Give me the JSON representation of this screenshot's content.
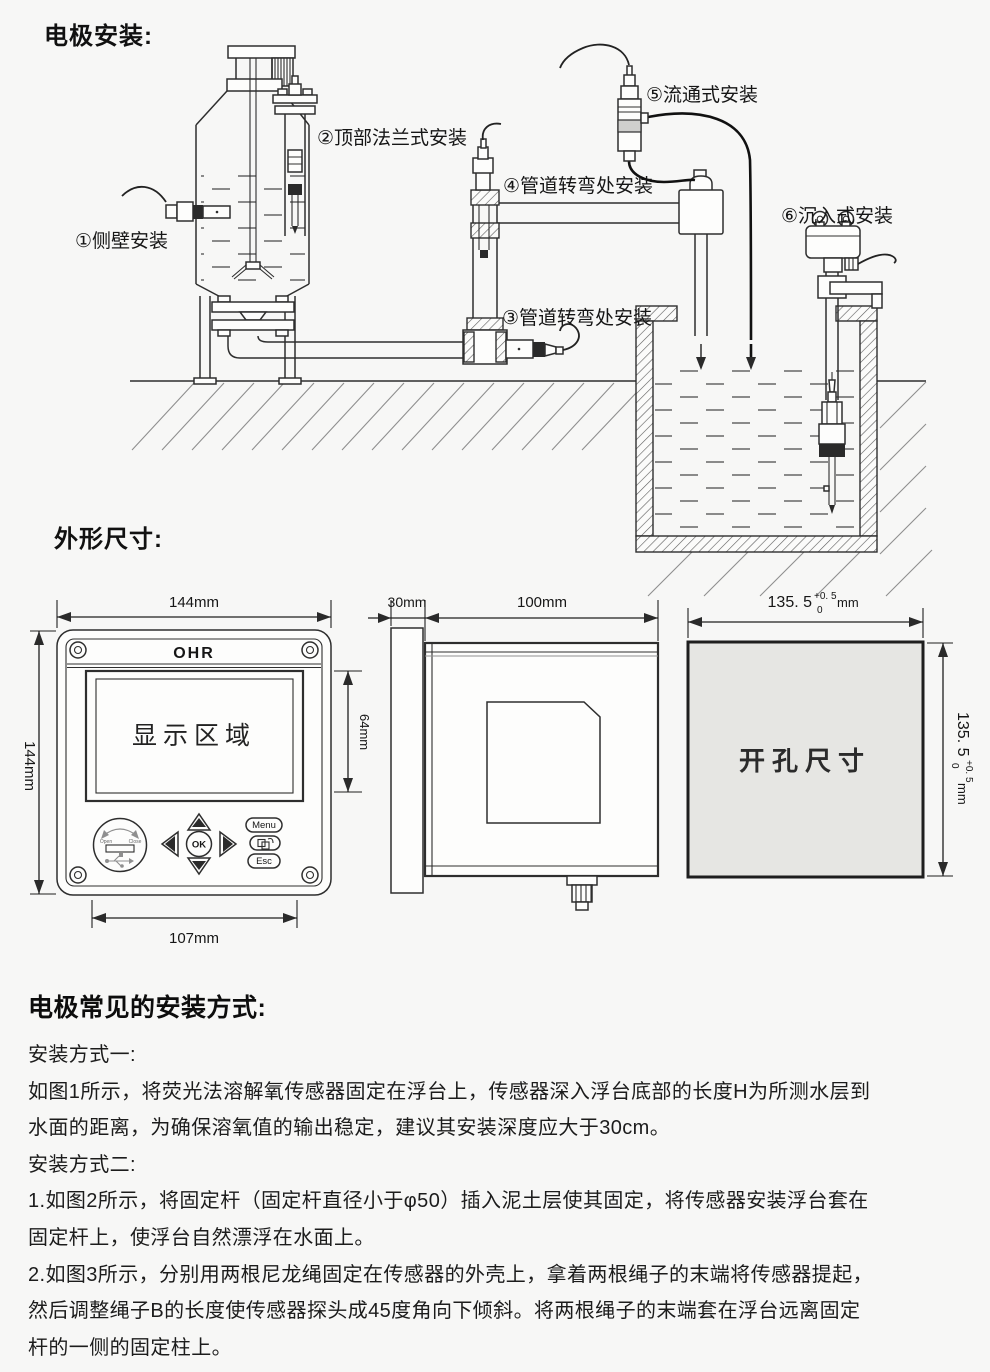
{
  "titles": {
    "electrode_install": "电极安装:",
    "outline_dims": "外形尺寸:",
    "common_methods": "电极常见的安装方式:"
  },
  "diagram_labels": {
    "l1": "①侧壁安装",
    "l2": "②顶部法兰式安装",
    "l3": "③管道转弯处安装",
    "l4": "④管道转弯处安装",
    "l5": "⑤流通式安装",
    "l6": "⑥沉入式安装"
  },
  "front_view": {
    "brand": "OHR",
    "display_area": "显示区域",
    "dim_width": "144mm",
    "dim_height": "144mm",
    "dim_display": "64mm",
    "dim_keypad": "107mm",
    "btn_menu": "Menu",
    "btn_esc": "Esc",
    "btn_ok": "OK",
    "usb_open": "Open",
    "usb_close": "Close"
  },
  "side_view": {
    "dim_bezel": "30mm",
    "dim_depth": "100mm"
  },
  "cutout_view": {
    "label": "开孔尺寸",
    "dim_value": "135. 5",
    "tol_plus": "+0. 5",
    "tol_minus": "0",
    "unit": "mm"
  },
  "methods_text": {
    "lines": [
      "安装方式一:",
      "如图1所示，将荧光法溶解氧传感器固定在浮台上，传感器深入浮台底部的长度H为所测水层到",
      "水面的距离，为确保溶氧值的输出稳定，建议其安装深度应大于30cm。",
      "安装方式二:",
      "1.如图2所示，将固定杆（固定杆直径小于φ50）插入泥土层使其固定，将传感器安装浮台套在",
      "固定杆上，使浮台自然漂浮在水面上。",
      "2.如图3所示，分别用两根尼龙绳固定在传感器的外壳上，拿着两根绳子的末端将传感器提起，",
      "然后调整绳子B的长度使传感器探头成45度角向下倾斜。将两根绳子的末端套在浮台远离固定",
      "杆的一侧的固定柱上。"
    ]
  }
}
